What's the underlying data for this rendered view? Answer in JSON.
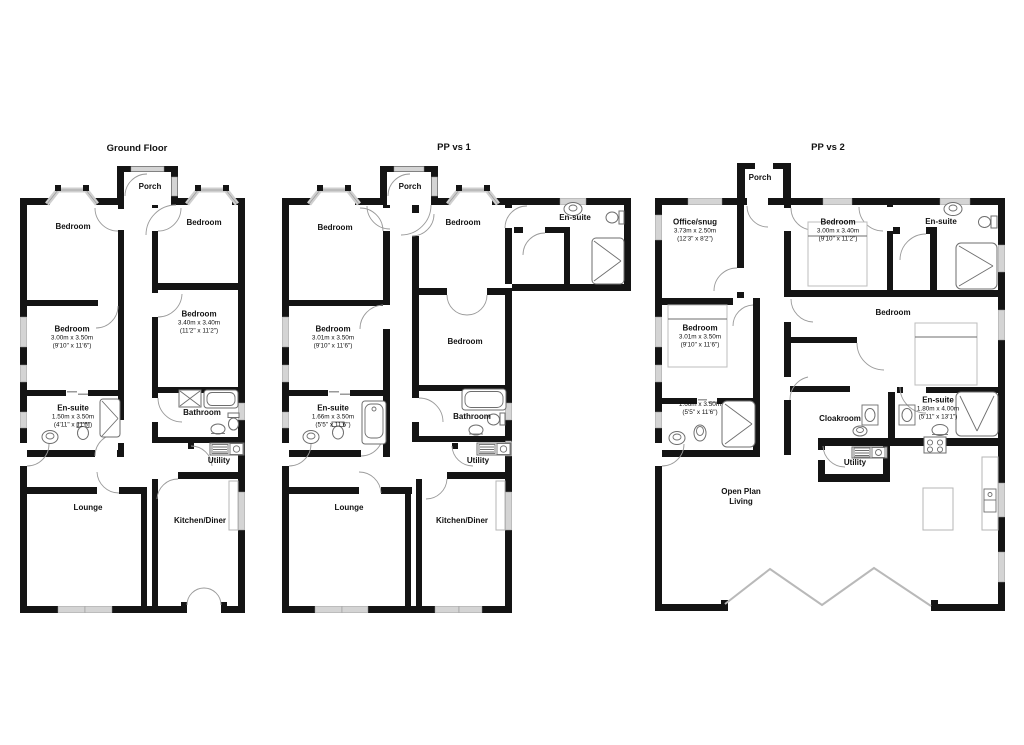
{
  "colors": {
    "wall": "#141414",
    "window": "#d4d4d4",
    "door_arc": "#9a9a9a",
    "fixture": "#6e6e6e"
  },
  "plans": [
    {
      "title": "Ground Floor",
      "rooms": [
        {
          "name": "Porch"
        },
        {
          "name": "Bedroom"
        },
        {
          "name": "Bedroom"
        },
        {
          "name": "Bedroom",
          "metric": "3.40m x 3.40m",
          "imperial": "(11'2\" x 11'2\")"
        },
        {
          "name": "Bedroom",
          "metric": "3.00m x 3.50m",
          "imperial": "(9'10\" x 11'6\")"
        },
        {
          "name": "En-suite",
          "metric": "1.50m x 3.50m",
          "imperial": "(4'11\" x 11'6\")"
        },
        {
          "name": "Bathroom"
        },
        {
          "name": "Utility"
        },
        {
          "name": "Lounge"
        },
        {
          "name": "Kitchen/Diner"
        }
      ]
    },
    {
      "title": "PP vs 1",
      "rooms": [
        {
          "name": "Porch"
        },
        {
          "name": "Bedroom"
        },
        {
          "name": "Bedroom"
        },
        {
          "name": "En-suite"
        },
        {
          "name": "Bedroom",
          "metric": "3.01m x 3.50m",
          "imperial": "(9'10\" x 11'6\")"
        },
        {
          "name": "Bedroom"
        },
        {
          "name": "En-suite",
          "metric": "1.66m x 3.50m",
          "imperial": "(5'5\" x 11'6\")"
        },
        {
          "name": "Bathroom"
        },
        {
          "name": "Utility"
        },
        {
          "name": "Lounge"
        },
        {
          "name": "Kitchen/Diner"
        }
      ]
    },
    {
      "title": "PP vs 2",
      "rooms": [
        {
          "name": "Porch"
        },
        {
          "name": "Office/snug",
          "metric": "3.73m x 2.50m",
          "imperial": "(12'3\" x 8'2\")"
        },
        {
          "name": "Bedroom",
          "metric": "3.00m x 3.40m",
          "imperial": "(9'10\" x 11'2\")"
        },
        {
          "name": "En-suite"
        },
        {
          "name": "Bedroom",
          "metric": "3.01m x 3.50m",
          "imperial": "(9'10\" x 11'6\")"
        },
        {
          "metric": "1.66m x 3.50m",
          "imperial": "(5'5\" x 11'6\")"
        },
        {
          "name": "Bedroom"
        },
        {
          "name": "En-suite",
          "metric": "1.80m x 4.00m",
          "imperial": "(5'11\" x 13'1\")"
        },
        {
          "name": "Cloakroom"
        },
        {
          "name": "Utility"
        },
        {
          "name": "Open Plan Living"
        }
      ]
    }
  ]
}
